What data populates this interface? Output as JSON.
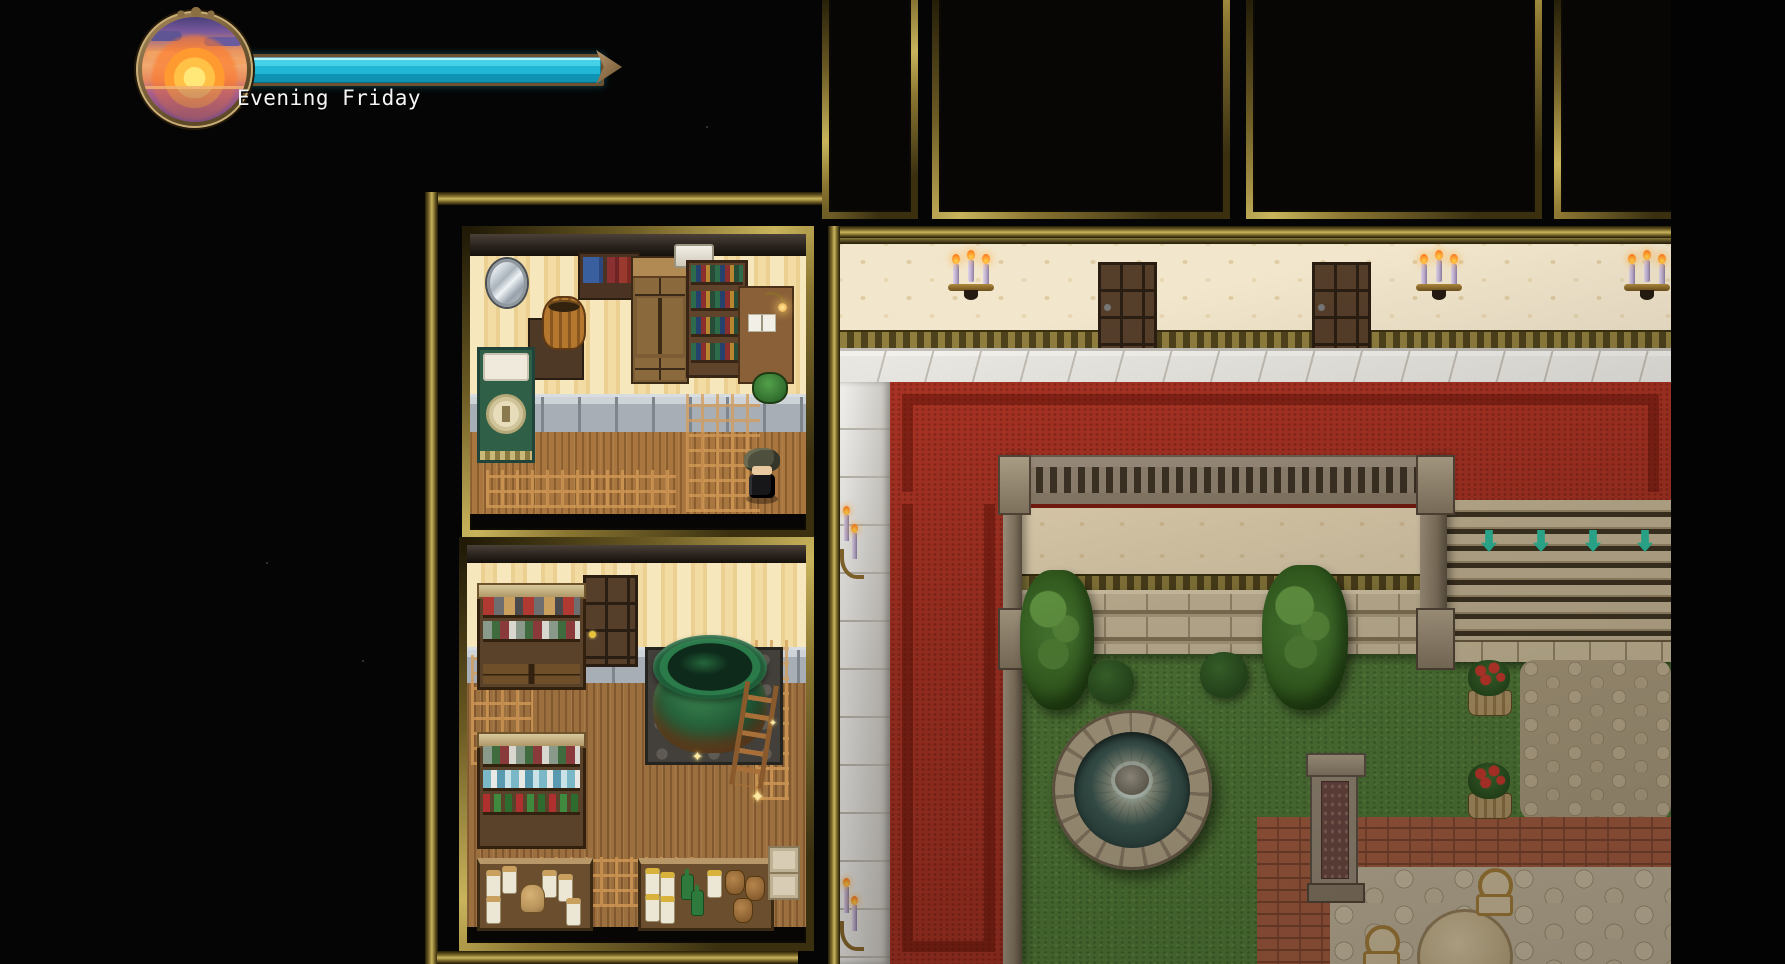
{
  "hud": {
    "time_label": "Evening Friday",
    "clock_icon": "sunset-clock-icon",
    "timebar": {
      "progress_percent": 100,
      "fill_color": "#20b6d4",
      "frame_color": "#6e5230",
      "tip": "arrow-right"
    }
  },
  "palette": {
    "background": "#050505",
    "frame_gold": "#c9b45c",
    "carpet_red": "#a93324",
    "grass_green": "#537e3a",
    "marble_white": "#e9e7e1",
    "wood_floor": "#a9763f",
    "wallpaper_cream": "#f2e6cc",
    "cauldron_green": "#1f5735",
    "stair_marker_teal": "#2ec0a0"
  },
  "scene": {
    "sparkle_glyph": "✦",
    "player": {
      "name": "player-character",
      "facing": "down",
      "hair_color": "#4e4f3c",
      "outfit_color": "#17171a"
    },
    "rooms": [
      {
        "id": "bedroom",
        "objects": [
          "mirror",
          "wall-shelf-books",
          "wardrobe",
          "bookshelf",
          "desk-with-open-book",
          "reading-lamp",
          "green-stool",
          "basket-table",
          "bed-with-emblem",
          "player-character"
        ]
      },
      {
        "id": "alchemy-room",
        "objects": [
          "wooden-door",
          "supply-shelf",
          "potion-shelf",
          "green-cauldron",
          "stone-platform",
          "ladder",
          "sparkles",
          "jar-table",
          "bottle-shelf",
          "crates"
        ]
      },
      {
        "id": "hallway",
        "doors": 2,
        "candelabra_sconces": 3
      },
      {
        "id": "courtyard",
        "stair_markers": 4,
        "hedges": 2,
        "bushes": 2,
        "flower_planters": 2,
        "objects": [
          "red-carpet",
          "balustrade",
          "columns",
          "lower-wall",
          "ledge-steps",
          "stairs",
          "fountain",
          "cobblestone-patch",
          "brick-path",
          "stone-monument",
          "patio-table",
          "chairs",
          "wall-candle-sconces"
        ]
      }
    ]
  }
}
